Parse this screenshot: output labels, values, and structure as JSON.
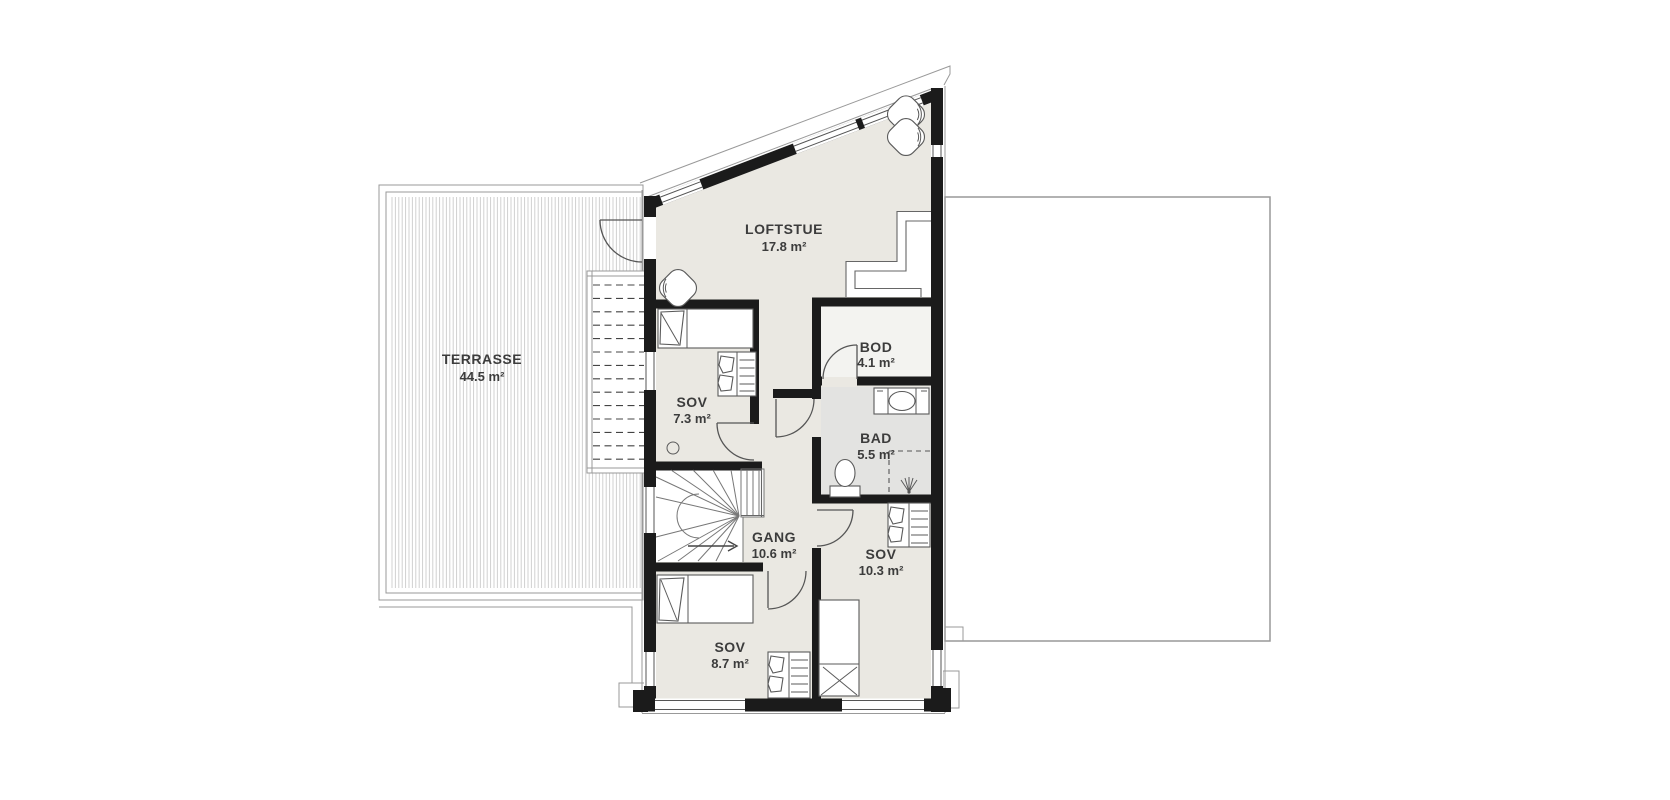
{
  "plan": {
    "type": "floor-plan",
    "language": "Norwegian",
    "floor": "loft / upper floor"
  },
  "rooms": [
    {
      "id": "terrasse",
      "name": "TERRASSE",
      "area": "44.5 m²"
    },
    {
      "id": "loftstue",
      "name": "LOFTSTUE",
      "area": "17.8 m²"
    },
    {
      "id": "sov-nw",
      "name": "SOV",
      "area": "7.3 m²"
    },
    {
      "id": "bod",
      "name": "BOD",
      "area": "4.1 m²"
    },
    {
      "id": "bad",
      "name": "BAD",
      "area": "5.5 m²"
    },
    {
      "id": "gang",
      "name": "GANG",
      "area": "10.6 m²"
    },
    {
      "id": "sov-se",
      "name": "SOV",
      "area": "10.3 m²"
    },
    {
      "id": "sov-sw",
      "name": "SOV",
      "area": "8.7 m²"
    }
  ],
  "fixtures": {
    "terrasse": [
      "deck-boards",
      "outdoor-stair-icon"
    ],
    "loftstue": [
      "armchair-icon",
      "armchair-icon",
      "stair-void-railing"
    ],
    "sov_nw": [
      "bed-icon",
      "wardrobe-icon",
      "downlight-icon"
    ],
    "bad": [
      "sink-vanity-icon",
      "toilet-icon",
      "shower-icon"
    ],
    "gang": [
      "winder-stair-icon",
      "stair-arrow-icon"
    ],
    "sov_se": [
      "bed-icon",
      "wardrobe-icon"
    ],
    "sov_sw": [
      "bed-icon",
      "wardrobe-icon"
    ]
  },
  "colors": {
    "wall": "#1b1b1b",
    "floor": "#eae8e2",
    "floorBad": "#e3e3e1",
    "floorBod": "#f3f3f0",
    "deckStripe": "#cbcbcb",
    "outline": "#999999",
    "furniture": "#5a5a5a",
    "text": "#3c3c3c"
  }
}
